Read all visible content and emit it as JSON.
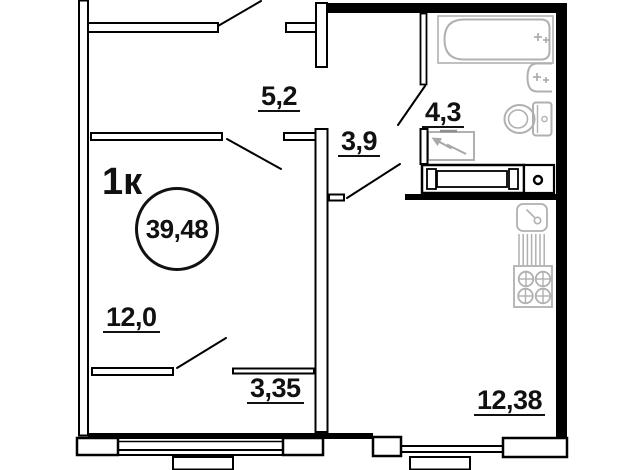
{
  "plan": {
    "apartment_type": "1к",
    "total_area": "39,48",
    "areas": {
      "hallway": "5,2",
      "bathroom": "4,3",
      "corridor": "3,9",
      "living_room": "12,0",
      "balcony": "3,35",
      "kitchen": "12,38"
    },
    "fixtures": [
      "bathtub",
      "wash-basin",
      "toilet",
      "electrical-panel",
      "kitchen-sink",
      "dish-drainer",
      "stove-4-burner",
      "vent-shaft",
      "built-in-unit"
    ],
    "colors": {
      "wall": "#000000",
      "fixture": "#b0b0b0",
      "text": "#111111",
      "background": "#ffffff"
    }
  }
}
